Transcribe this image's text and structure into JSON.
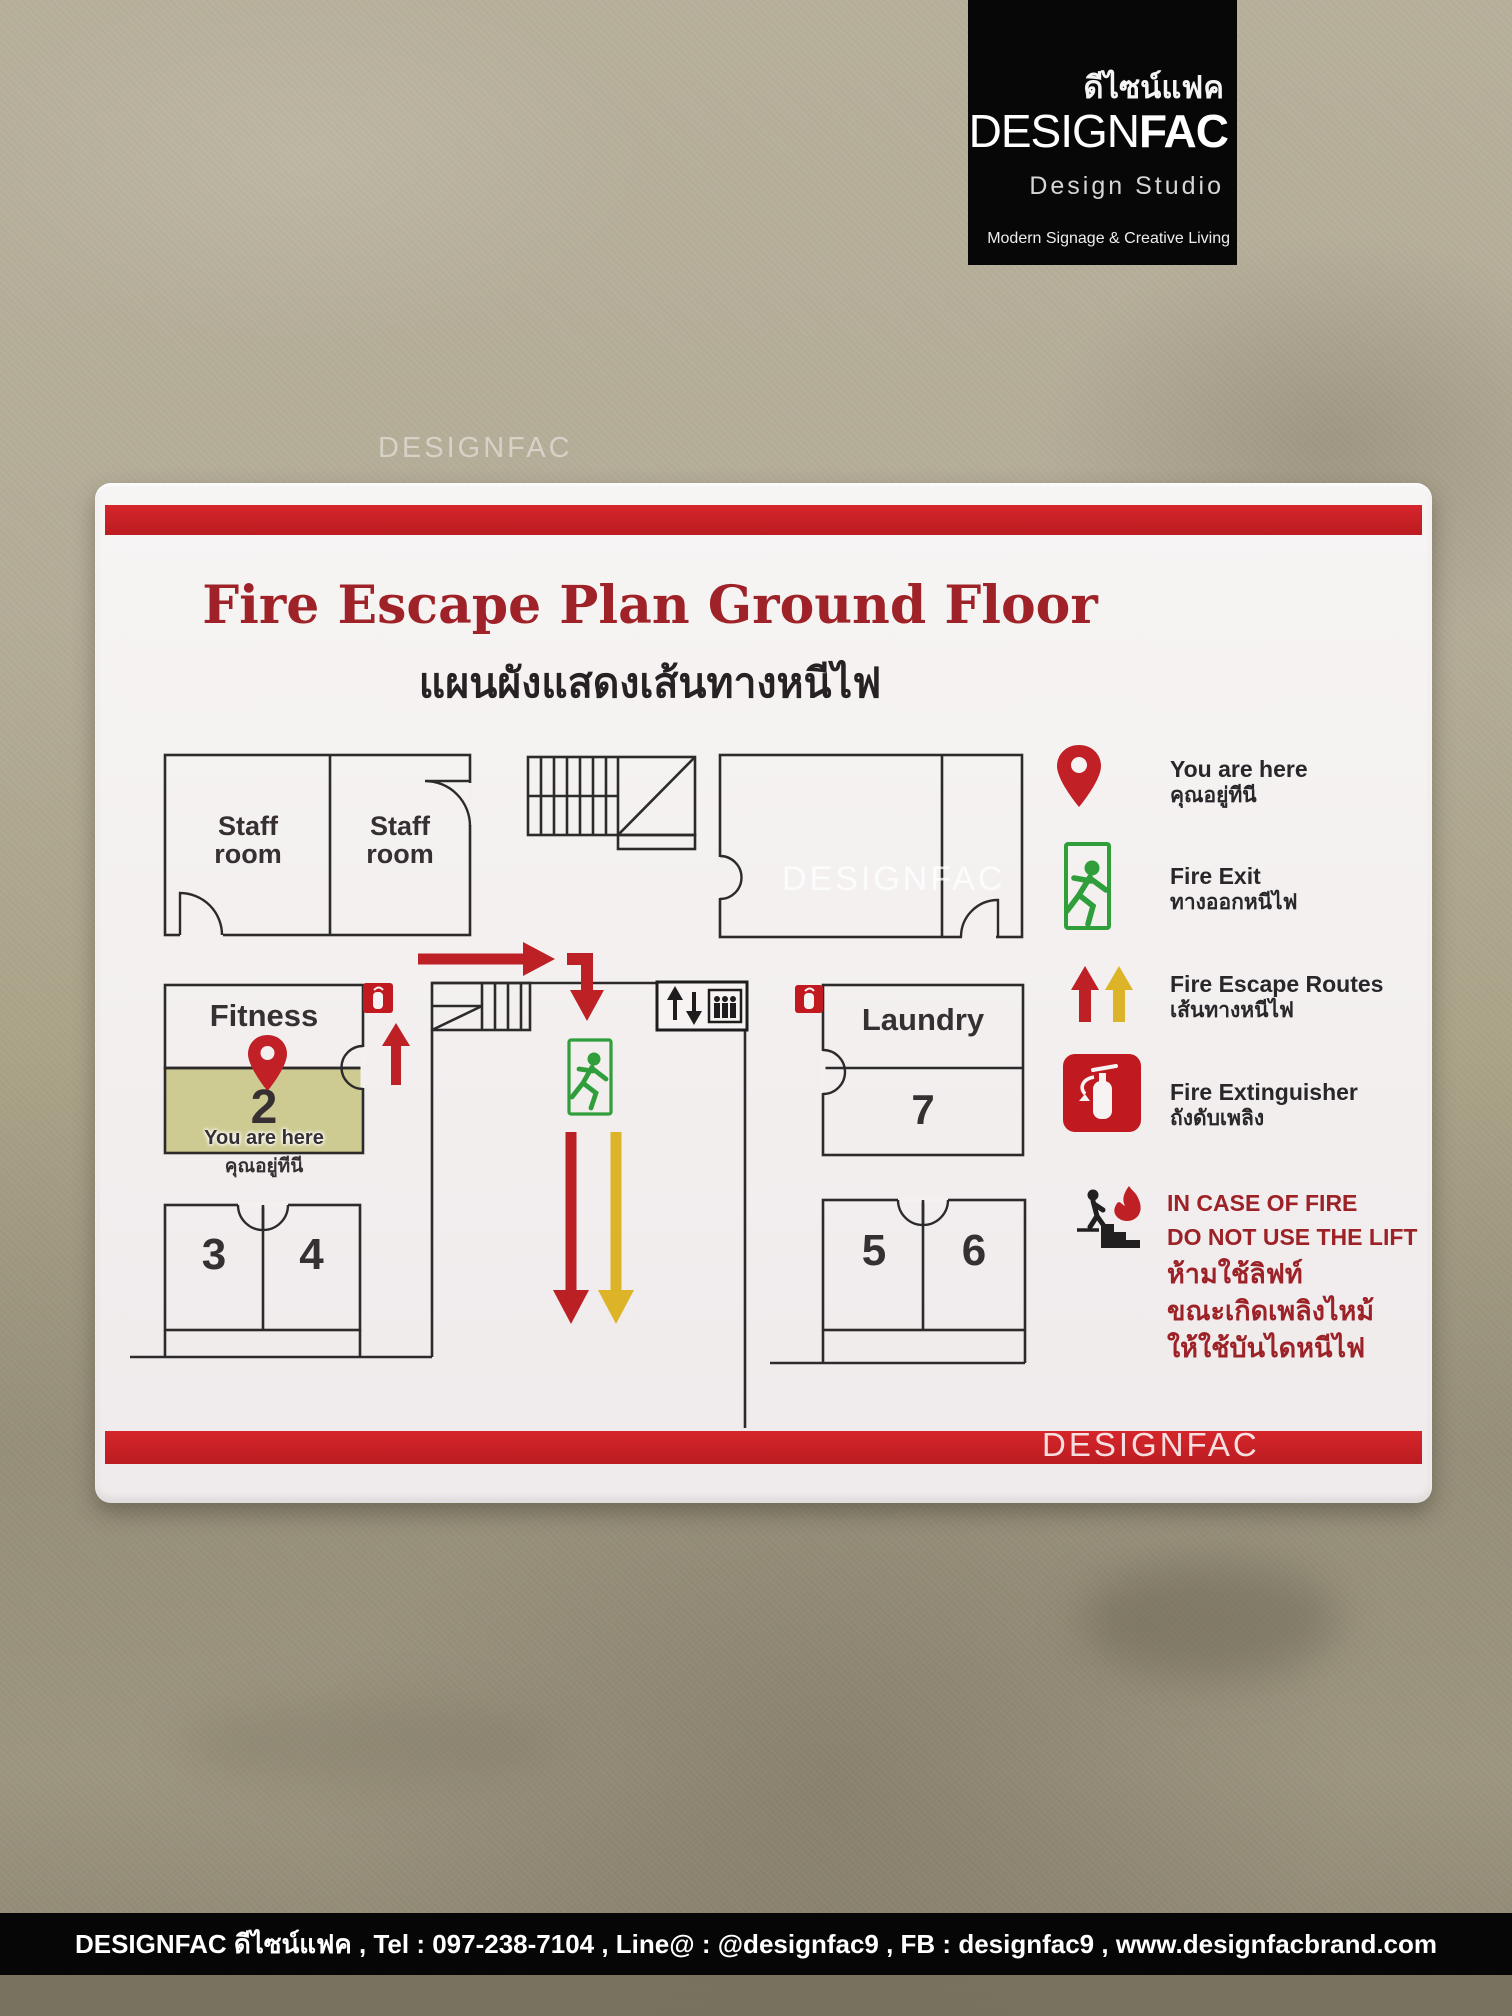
{
  "brand_logo": {
    "thai": "ดีไซน์แฟค",
    "name_light": "DESIGN",
    "name_bold": "FAC",
    "studio": "Design Studio",
    "tagline": "Modern Signage & Creative Living"
  },
  "watermarks": {
    "wall": "DESIGNFAC",
    "plan": "DESIGNFAC",
    "stripe": "DESIGNFAC"
  },
  "sign": {
    "title": "Fire Escape Plan Ground Floor",
    "subtitle": "แผนผังแสดงเส้นทางหนีไฟ",
    "rooms": {
      "staff_line1": "Staff",
      "staff_line2": "room",
      "fitness": "Fitness",
      "room2": "2",
      "you_are_here_en": "You are here",
      "you_are_here_th": "คุณอยู่ทีนี",
      "laundry": "Laundry",
      "room7": "7",
      "room3": "3",
      "room4": "4",
      "room5": "5",
      "room6": "6"
    },
    "legend": {
      "you_are_here": {
        "en": "You are here",
        "th": "คุณอยู่ทีนี"
      },
      "fire_exit": {
        "en": "Fire Exit",
        "th": "ทางออกหนีไฟ"
      },
      "escape_routes": {
        "en": "Fire Escape Routes",
        "th": "เส้นทางหนีไฟ"
      },
      "extinguisher": {
        "en": "Fire Extinguisher",
        "th": "ถังดับเพลิง"
      },
      "warning": {
        "line1": "IN CASE OF FIRE",
        "line2": "DO NOT USE THE LIFT",
        "line3": "ห้ามใช้ลิฟท์",
        "line4": "ขณะเกิดเพลิงไหม้",
        "line5": "ให้ใช้บันไดหนีไฟ"
      }
    }
  },
  "footer": "DESIGNFAC ดีไซน์แฟค , Tel : 097-238-7104 , Line@ : @designfac9 , FB : designfac9 , www.designfacbrand.com",
  "colors": {
    "accent_red": "#c1202a",
    "title_red": "#9e2227",
    "route_yellow": "#ddb427",
    "exit_green": "#2f9e3b",
    "highlight_room": "#cecb92"
  }
}
